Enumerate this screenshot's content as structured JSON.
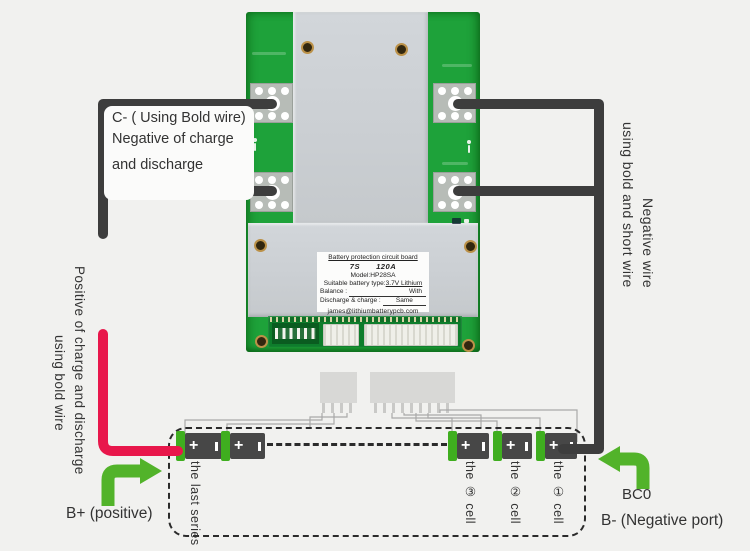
{
  "annotations": {
    "c_minus": {
      "line1": "C- ( Using Bold wire)",
      "line2": "Negative of charge",
      "line3": "and discharge"
    },
    "left_positive": {
      "line1": "Positive of charge and discharge",
      "line2": "using bold wire"
    },
    "right_negative": {
      "line1": "using bold and short wire",
      "line2": "Negative wire"
    },
    "b_plus": "B+ (positive)",
    "bc0": "BC0",
    "b_minus": "B- (Negative port)"
  },
  "board": {
    "label": {
      "title": "Battery protection circuit board",
      "series": "7S",
      "current": "120A",
      "model": "Model:HP28SA",
      "type_label": "Suitable battery type:",
      "type_value": "3.7V Lithium",
      "balance_label": "Balance :",
      "balance_value": "With",
      "discharge_label": "Discharge & charge :",
      "discharge_value": "Same",
      "email": "james@lithiumbatterypcb.com"
    }
  },
  "battery_pack": {
    "plus_symbol": "+",
    "cells": [
      {
        "label": "the last series"
      },
      {
        "label": ""
      },
      {
        "label": "the ③ cell"
      },
      {
        "label": "the ② cell"
      },
      {
        "label": "the ① cell"
      }
    ]
  },
  "colors": {
    "board_green": "#1ea23a",
    "aluminum": "#ccd0d4",
    "wire_black": "#3d3d3d",
    "wire_red": "#e8174b",
    "arrow_green": "#52b32a",
    "battery_body": "#474747",
    "battery_cap_green": "#3fae1f",
    "thin_wire": "#a9a9a9",
    "text": "#3a3a3a"
  }
}
